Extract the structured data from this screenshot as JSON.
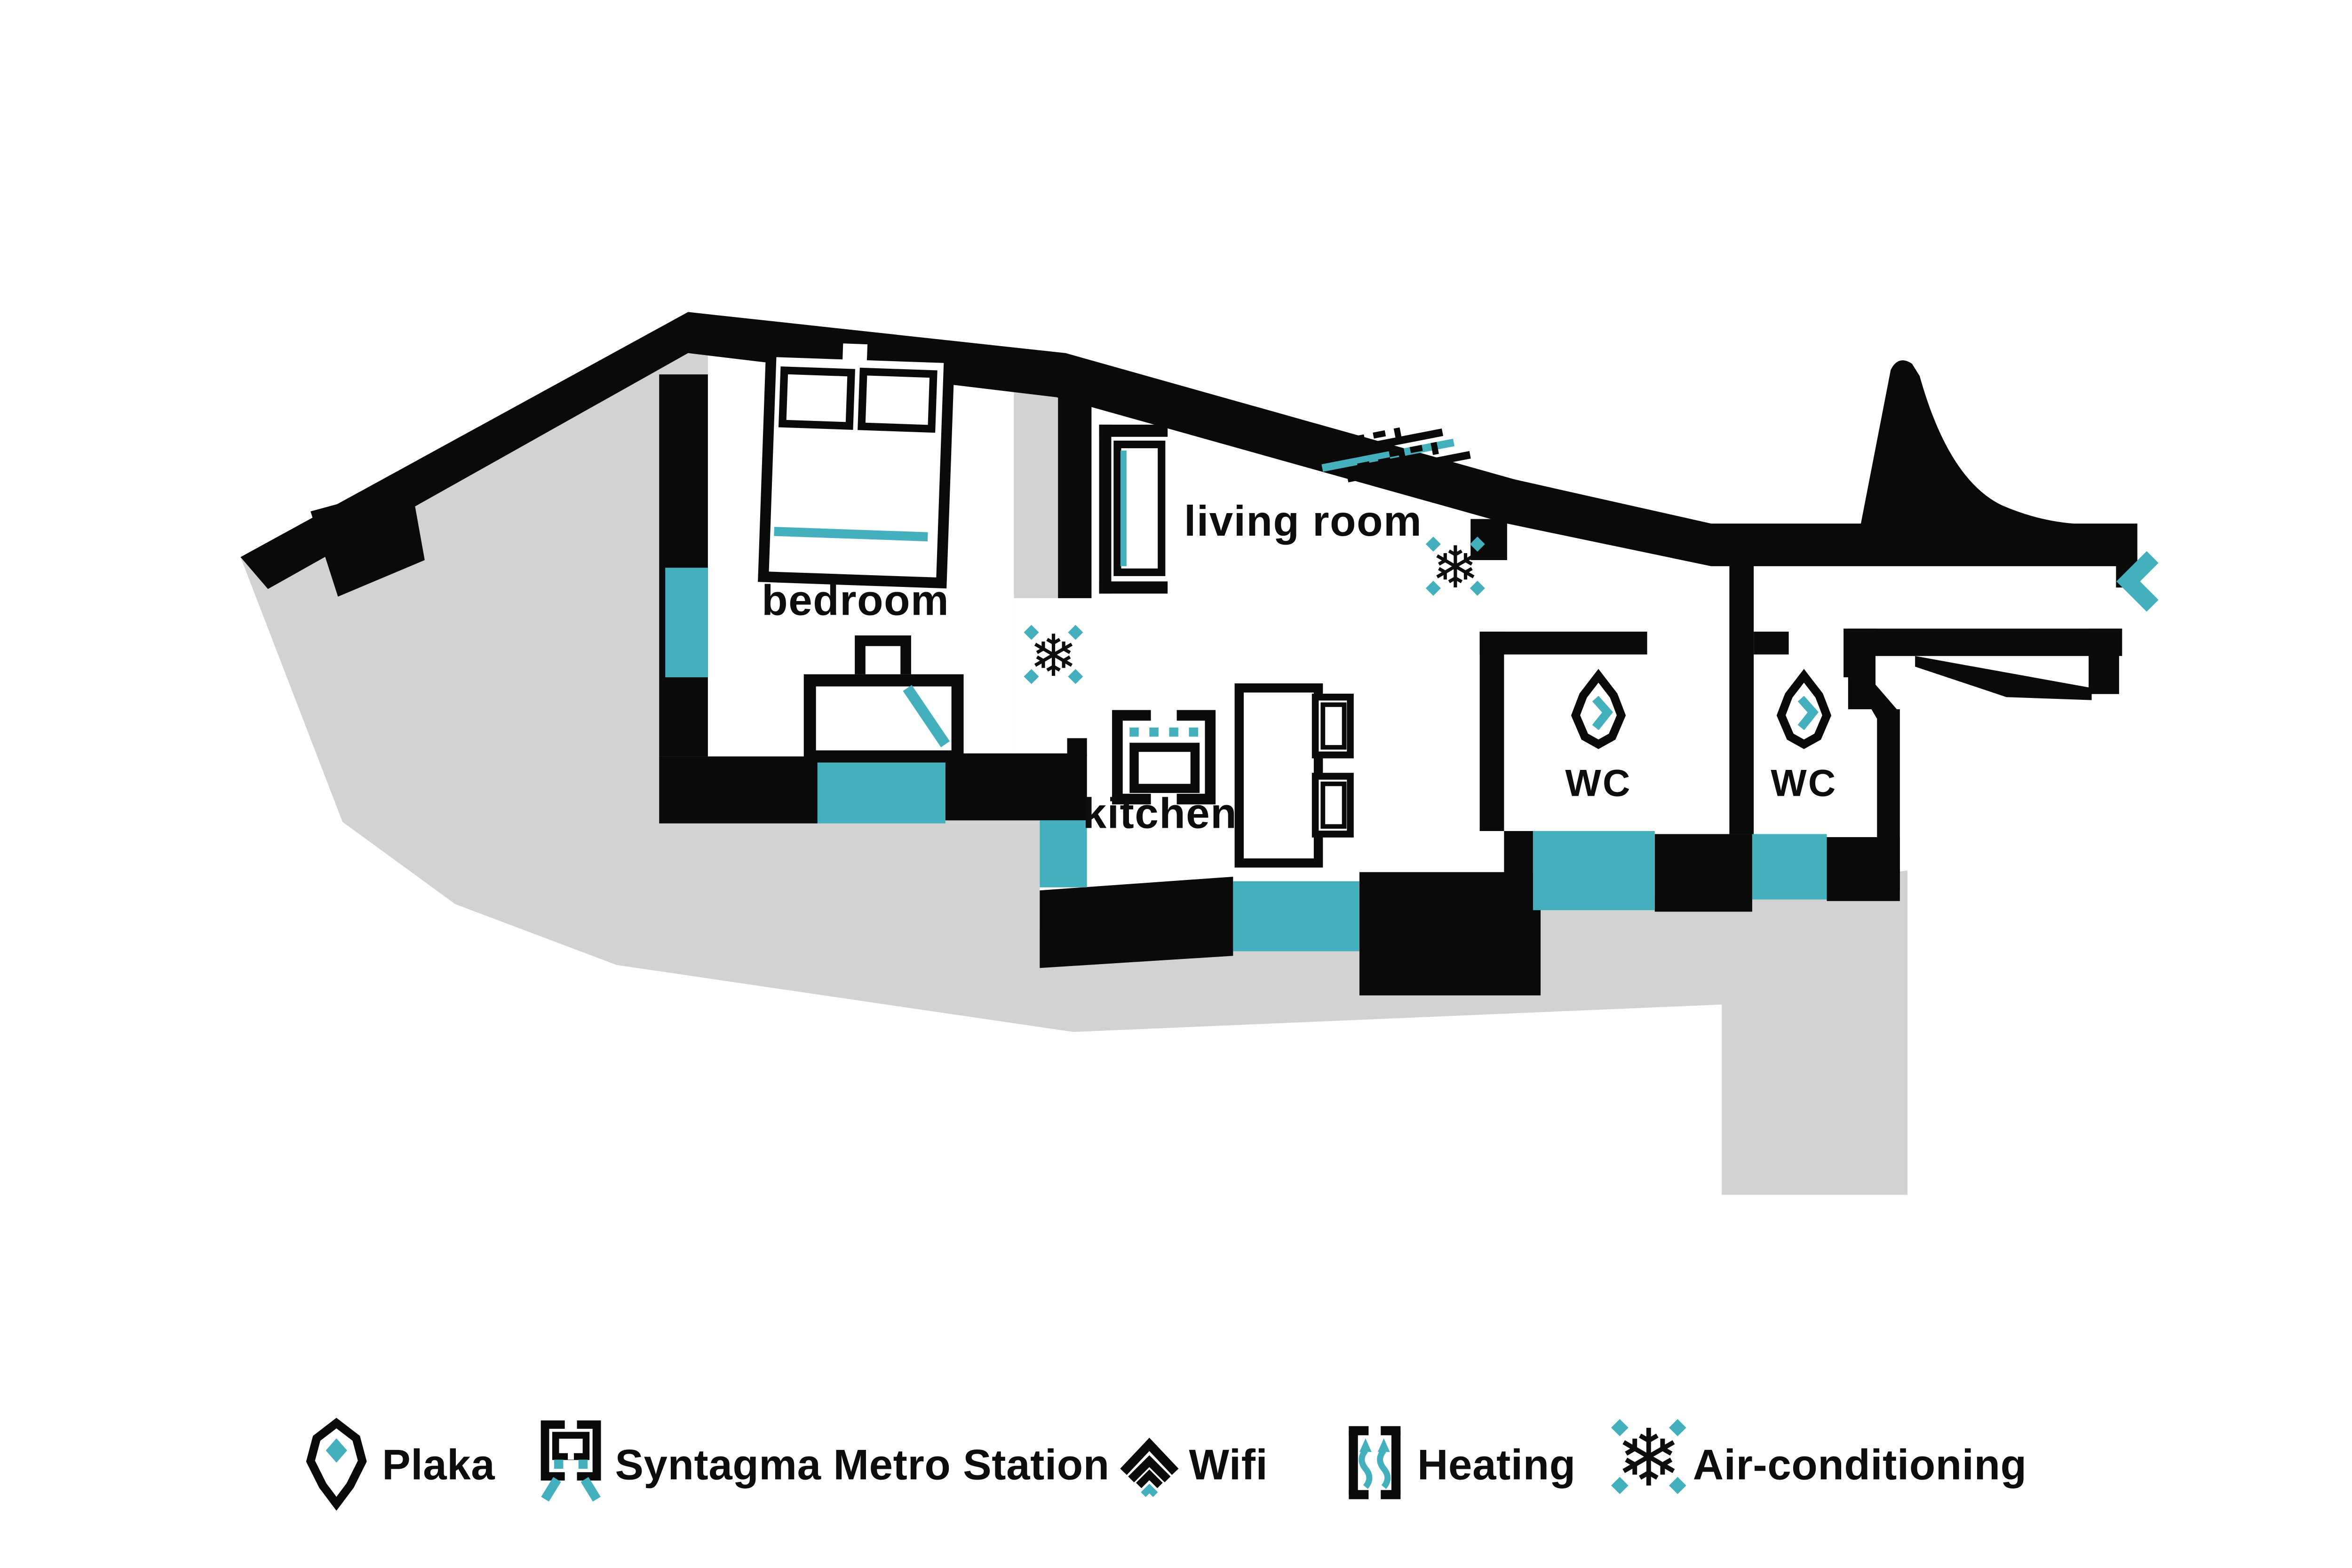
{
  "colors": {
    "black": "#0A0A0A",
    "teal": "#45B0BD",
    "gray": "#D2D2D2",
    "white": "#FFFFFF"
  },
  "rooms": {
    "bedroom": "bedroom",
    "living_room": "living room",
    "kitchen": "kitchen",
    "wc1": "WC",
    "wc2": "WC"
  },
  "icons": {
    "snowflake_glyph": "❄"
  },
  "legend": {
    "items": [
      {
        "icon": "location-pin-icon",
        "label": "Plaka"
      },
      {
        "icon": "metro-icon",
        "label": "Syntagma Metro Station"
      },
      {
        "icon": "wifi-icon",
        "label": "Wifi"
      },
      {
        "icon": "heating-icon",
        "label": "Heating"
      },
      {
        "icon": "air-conditioning-icon",
        "label": "Air-conditioning"
      }
    ]
  }
}
